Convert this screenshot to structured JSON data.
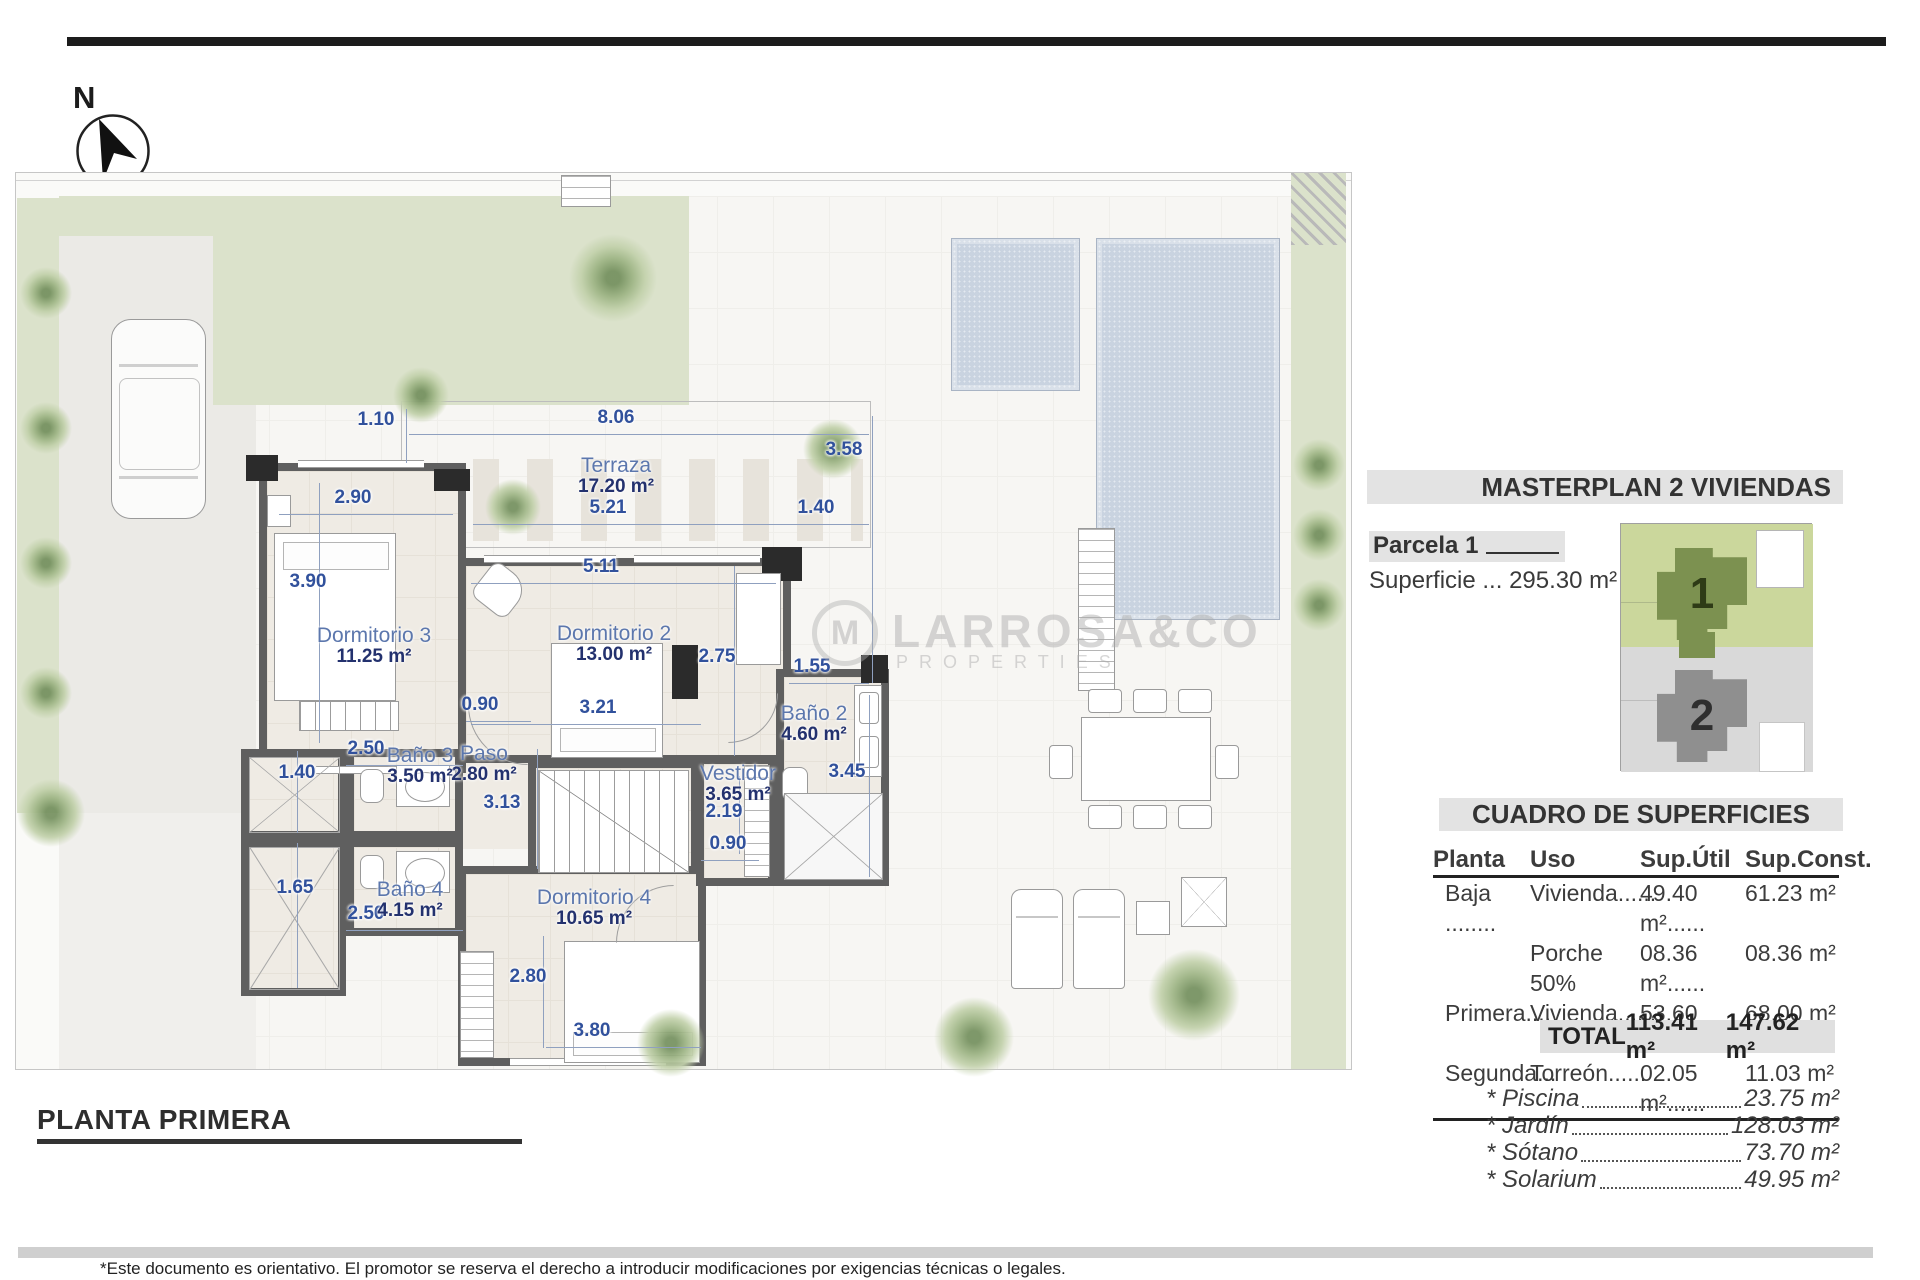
{
  "north_label": "N",
  "plan_title": "PLANTA PRIMERA",
  "disclaimer": "*Este documento es orientativo. El promotor se reserva el derecho a introducir modificaciones por exigencias técnicas o legales.",
  "watermark": {
    "name": "LARROSA&CO",
    "sub": "PROPERTIES",
    "glyph": "M"
  },
  "masterplan": {
    "title": "MASTERPLAN 2 VIVIENDAS",
    "parcela_label": "Parcela 1",
    "superficie_line": "Superficie ... 295.30 m²",
    "plot1": "1",
    "plot2": "2"
  },
  "cuadro": {
    "title": "CUADRO DE SUPERFICIES",
    "headers": [
      "Planta",
      "Uso",
      "Sup.Útil",
      "Sup.Const."
    ],
    "rows": [
      [
        "Baja ........",
        "Vivienda......",
        "49.40 m²......",
        "61.23 m²"
      ],
      [
        "",
        "Porche 50%",
        "08.36 m²......",
        "08.36 m²"
      ],
      [
        "Primera....",
        "Vivienda......",
        "53.60 m²......",
        "68.00 m²"
      ],
      [
        "Segunda...",
        "Torreón......",
        "02.05 m²......",
        "11.03 m²"
      ]
    ],
    "total_label": "TOTAL",
    "total_util": "113.41 m²",
    "total_const": "147.62 m²"
  },
  "extras": [
    {
      "label": "* Piscina",
      "value": "23.75 m²"
    },
    {
      "label": "* Jardín",
      "value": "128.03 m²"
    },
    {
      "label": "* Sótano",
      "value": "73.70 m²"
    },
    {
      "label": "* Solarium",
      "value": "49.95 m²"
    }
  ],
  "rooms": [
    {
      "name": "Terraza",
      "area": "17.20 m²"
    },
    {
      "name": "Dormitorio 3",
      "area": "11.25 m²"
    },
    {
      "name": "Dormitorio 2",
      "area": "13.00 m²"
    },
    {
      "name": "Paso",
      "area": "2.80 m²"
    },
    {
      "name": "Baño 3",
      "area": "3.50 m²"
    },
    {
      "name": "Baño 4",
      "area": "4.15 m²"
    },
    {
      "name": "Dormitorio 4",
      "area": "10.65 m²"
    },
    {
      "name": "Vestidor",
      "area": "3.65 m²"
    },
    {
      "name": "Baño 2",
      "area": "4.60 m²"
    }
  ],
  "dims": [
    "8.06",
    "1.10",
    "5.21",
    "1.40",
    "3.58",
    "5.11",
    "2.90",
    "3.90",
    "3.21",
    "2.75",
    "0.90",
    "3.13",
    "2.50",
    "1.40",
    "1.65",
    "2.50",
    "2.80",
    "3.80",
    "1.55",
    "3.45",
    "2.19",
    "0.90"
  ],
  "colors": {
    "dim_blue": "#31519c",
    "room_name_blue": "#5c77ad",
    "area_navy": "#23316e",
    "garden_green": "#dbe2cb",
    "pool_blue": "#c9d3e0",
    "wall_gray": "#5f5f5f",
    "bar_gray": "#e3e3e3"
  }
}
